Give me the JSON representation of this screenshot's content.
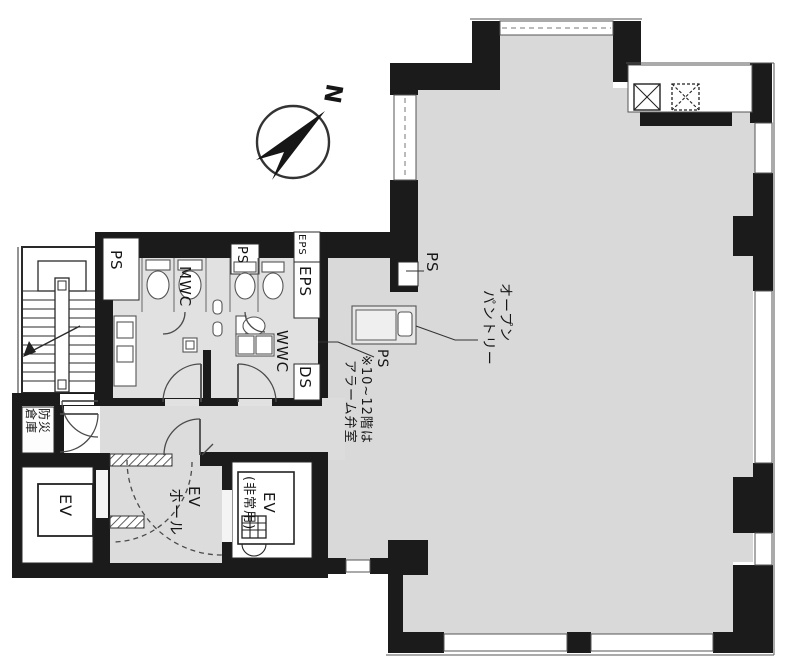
{
  "plan": {
    "type": "japanese-floor-plan",
    "orientation_note": "plan rotated 90deg, all labels read top-to-bottom",
    "compass": {
      "north_label": "N"
    },
    "colors": {
      "wall": "#1b1b1b",
      "floor_main": "#d9d9d9",
      "floor_service": "#e1e1e1",
      "line": "#444444",
      "background": "#ffffff"
    },
    "rooms": {
      "stairwell": {
        "name": "stairwell",
        "label": ""
      },
      "ps_stair": {
        "label": "PS"
      },
      "mens_wc": {
        "label": "MWC"
      },
      "ps_center": {
        "label": "PS"
      },
      "eps_top": {
        "label": "EPS"
      },
      "eps": {
        "label": "EPS"
      },
      "womens_wc": {
        "label": "WWC"
      },
      "ds": {
        "label": "DS"
      },
      "ps_right": {
        "label": "PS"
      },
      "open_pantry": {
        "line1": "オープン",
        "line2": "パントリー"
      },
      "ps_note": {
        "ps": "PS",
        "line1": "※10~12階は",
        "line2": "アラーム弁室"
      },
      "disaster_storage": {
        "line1": "防災",
        "line2": "倉庫"
      },
      "elevator": {
        "label": "EV"
      },
      "elevator_hall": {
        "line1": "EV",
        "line2": "ホール"
      },
      "elevator_emergency": {
        "line1": "EV",
        "line2": "(非常用)"
      }
    }
  }
}
